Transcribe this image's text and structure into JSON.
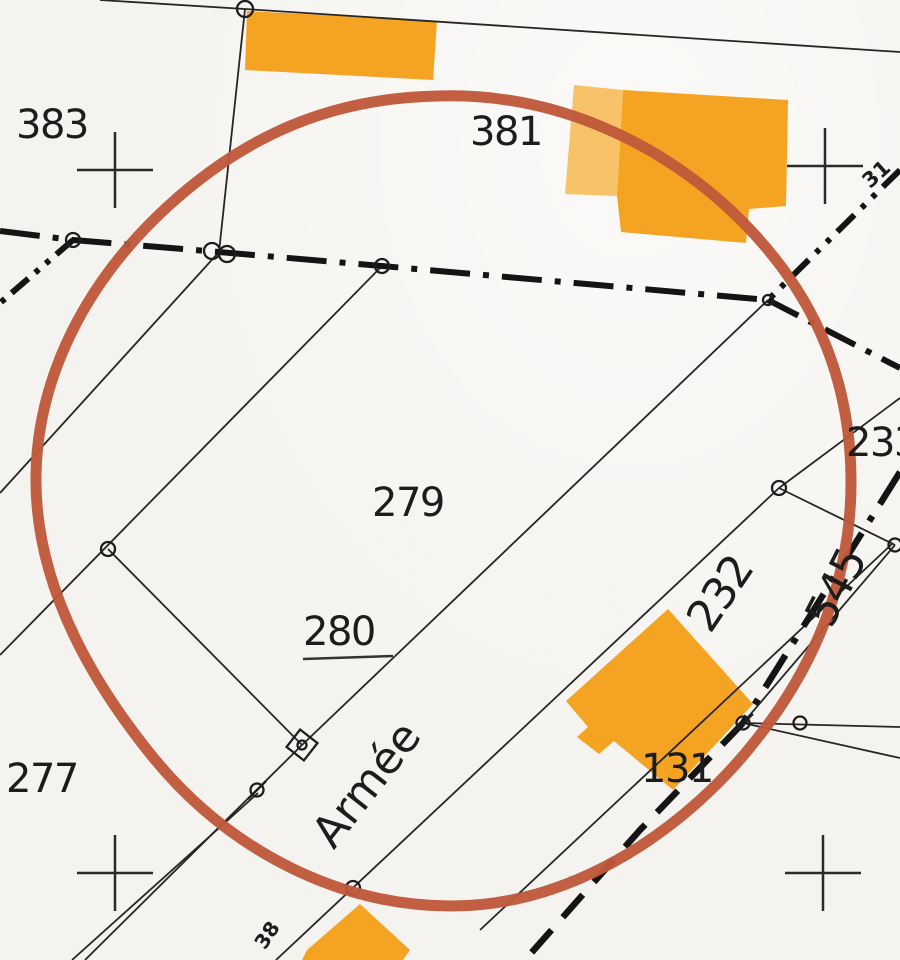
{
  "labels": {
    "parcels": [
      {
        "text": "383"
      },
      {
        "text": "381"
      },
      {
        "text": "279"
      },
      {
        "text": "280"
      },
      {
        "text": "277"
      },
      {
        "text": "232"
      },
      {
        "text": "545"
      },
      {
        "text": "131"
      },
      {
        "text": "233"
      }
    ],
    "street": {
      "text": "Armée"
    },
    "small": [
      {
        "text": "31"
      },
      {
        "text": "38"
      }
    ]
  },
  "colors": {
    "paper": "#f5f3ef",
    "building": "#f5a322",
    "building_light": "#f8c368",
    "annotation_circle": "#c0583a",
    "line": "#1d1d1d"
  }
}
